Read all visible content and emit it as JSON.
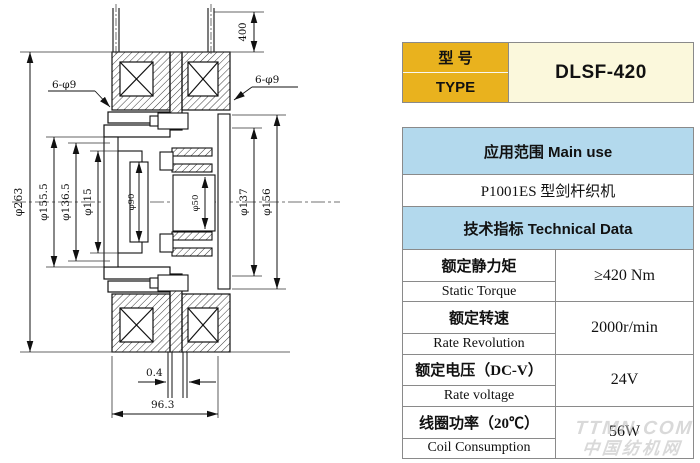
{
  "drawing": {
    "labels": {
      "lead_length": "400",
      "holes_left": "6-φ9",
      "holes_right": "6-φ9",
      "d_outer": "φ263",
      "d155": "φ155.5",
      "d136": "φ136.5",
      "d115": "φ115",
      "d90": "φ90",
      "d50": "φ50",
      "d137": "φ137",
      "d156": "φ156",
      "gap": "0.4",
      "total_width": "96.3"
    }
  },
  "spec_table": {
    "type_row": {
      "cn": "型 号",
      "en": "TYPE",
      "value": "DLSF-420"
    },
    "main_use_header": "应用范围  Main use",
    "main_use_value": "P1001ES  型剑杆织机",
    "tech_header": "技术指标  Technical Data",
    "rows": [
      {
        "cn": "额定静力矩",
        "en": "Static Torque",
        "value": "≥420 Nm"
      },
      {
        "cn": "额定转速",
        "en": "Rate Revolution",
        "value": "2000r/min"
      },
      {
        "cn": "额定电压（DC-V）",
        "en": "Rate voltage",
        "value": "24V"
      },
      {
        "cn": "线圈功率（20℃）",
        "en": "Coil Consumption",
        "value": "56W"
      }
    ]
  },
  "watermark": {
    "line1": "TTMN.COM",
    "line2": "中国纺机网"
  },
  "colors": {
    "header_yellow": "#E9B21E",
    "value_cream": "#FBF8DC",
    "header_blue": "#B3D9ED",
    "line_gray": "#8a8a8a"
  }
}
